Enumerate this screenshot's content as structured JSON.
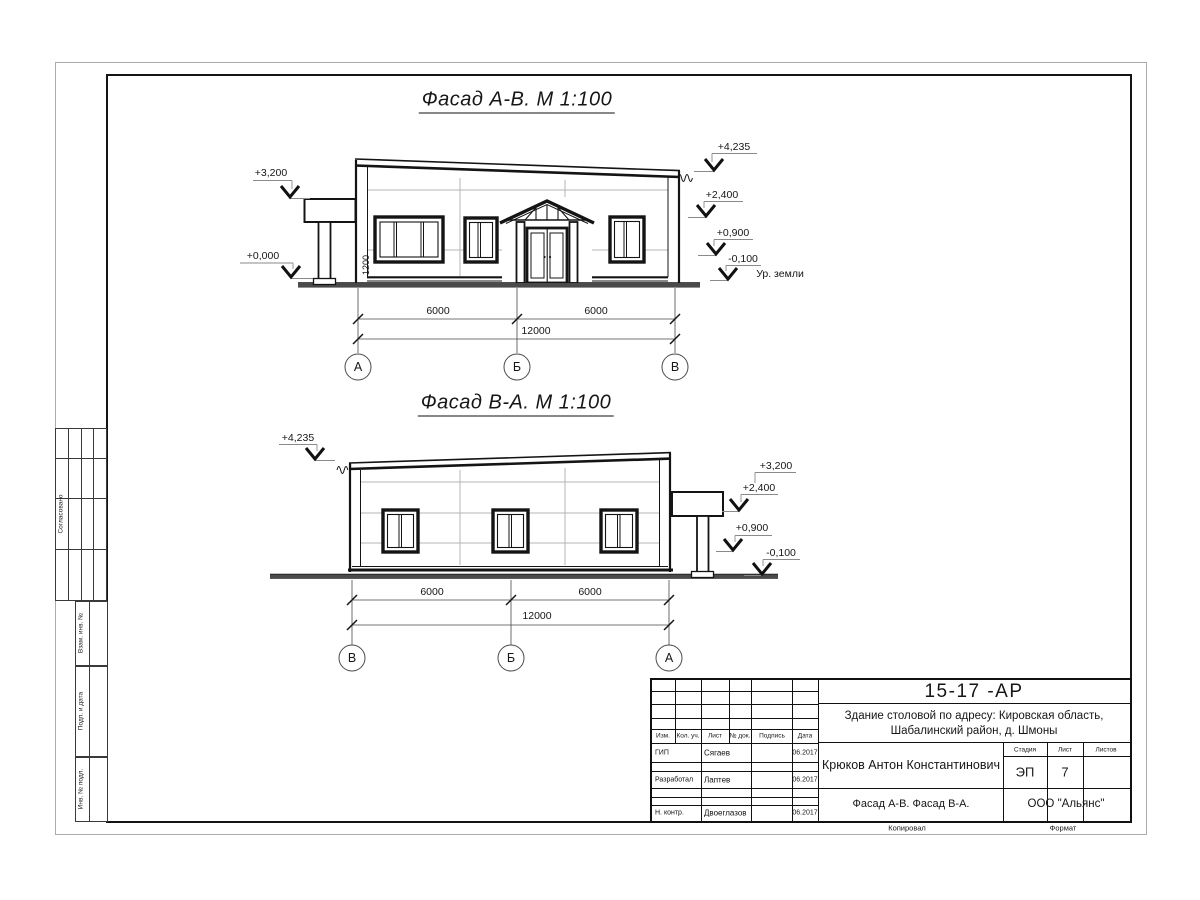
{
  "titles": {
    "facade_ab": "Фасад А-В.  М 1:100",
    "facade_ba": "Фасад В-А.  М 1:100"
  },
  "facade_ab": {
    "elev_left_top": "+3,200",
    "elev_left_bottom": "+0,000",
    "elev_right_1": "+4,235",
    "elev_right_2": "+2,400",
    "elev_right_3": "+0,900",
    "elev_right_4": "-0,100",
    "ground_label": "Ур. земли",
    "door_height_dim": "1200",
    "dim_left": "6000",
    "dim_right": "6000",
    "dim_total": "12000",
    "axis_1": "А",
    "axis_2": "Б",
    "axis_3": "В"
  },
  "facade_ba": {
    "elev_left_1": "+4,235",
    "elev_right_1": "+3,200",
    "elev_right_2": "+2,400",
    "elev_right_3": "+0,900",
    "elev_right_4": "-0,100",
    "dim_left": "6000",
    "dim_right": "6000",
    "dim_total": "12000",
    "axis_1": "В",
    "axis_2": "Б",
    "axis_3": "А"
  },
  "stamp": {
    "doc_number": "15-17 -АР",
    "project_line1": "Здание столовой по адресу: Кировская область,",
    "project_line2": "Шабалинский район, д. Шмоны",
    "author": "Крюков Антон Константинович",
    "drawing_title": "Фасад А-В. Фасад В-А.",
    "company": "ООО \"Альянс\"",
    "col_izm": "Изм.",
    "col_kol": "Кол. уч.",
    "col_list": "Лист",
    "col_doc": "№ док.",
    "col_sign": "Подпись",
    "col_date": "Дата",
    "row1_role": "ГИП",
    "row1_name": "Сягаев",
    "row1_date": "06.2017",
    "row2_role": "Разработал",
    "row2_name": "Лаптев",
    "row2_date": "06.2017",
    "row3_role": "Н. контр.",
    "row3_name": "Двоеглазов",
    "row3_date": "06.2017",
    "stage_label": "Стадия",
    "stage_value": "ЭП",
    "list_label": "Лист",
    "list_value": "7",
    "listov_label": "Листов",
    "copied_label": "Копировал",
    "format_label": "Формат"
  },
  "margin": {
    "approved": "Согласовано",
    "vzam": "Взам. инв. №",
    "podp": "Подп. и дата",
    "inv": "Инв. № подл."
  }
}
